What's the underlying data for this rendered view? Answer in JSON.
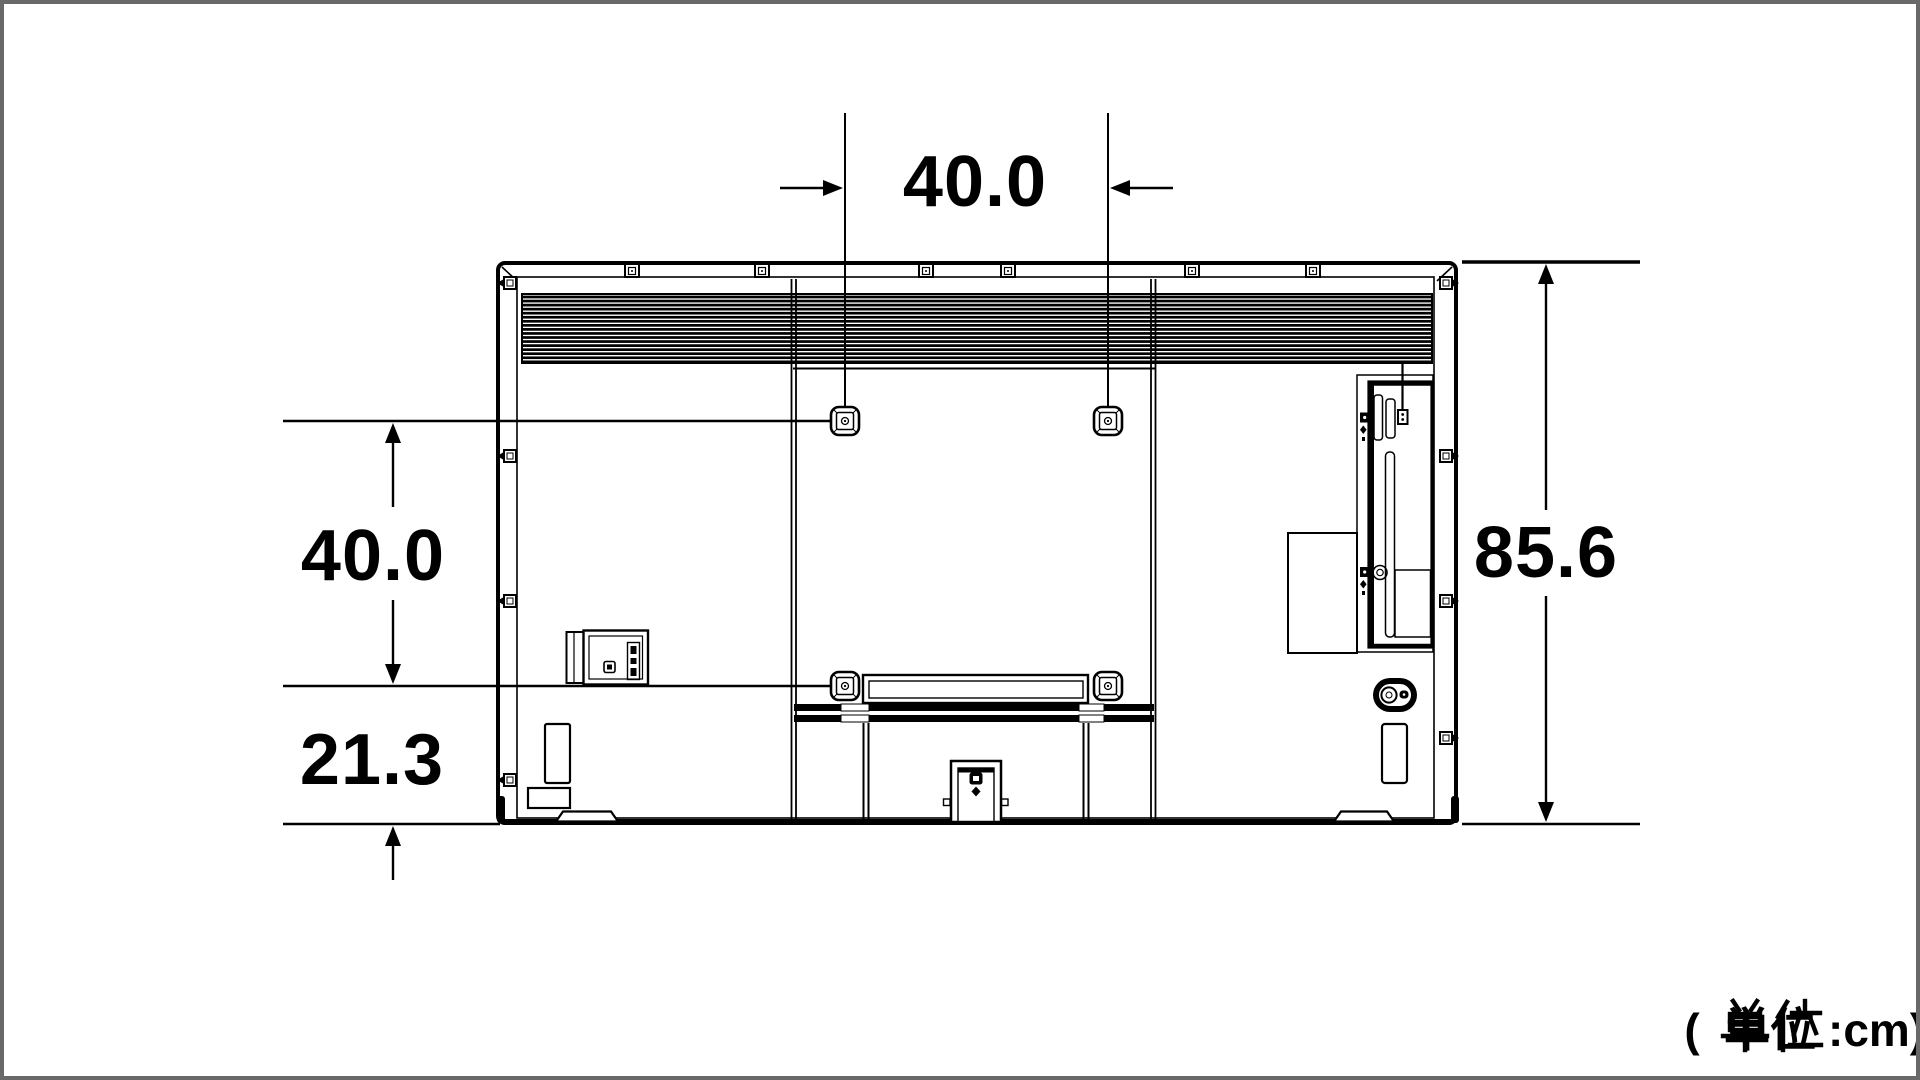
{
  "diagram": {
    "type_note": "TV rear view dimension drawing",
    "unit": "cm",
    "labels": {
      "dim_top": "40.0",
      "dim_left": "40.0",
      "dim_bottom_left": "21.3",
      "dim_right": "85.6",
      "unit_prefix": "(",
      "unit_kanji": "単位",
      "unit_suffix": ":cm)",
      "unit_full": "( 単位 :cm)"
    },
    "dimensions_cm": {
      "vesa_hole_spacing_horizontal": 40.0,
      "vesa_hole_spacing_vertical": 40.0,
      "vesa_bottom_row_to_bottom_edge": 21.3,
      "overall_height": 85.6
    }
  }
}
